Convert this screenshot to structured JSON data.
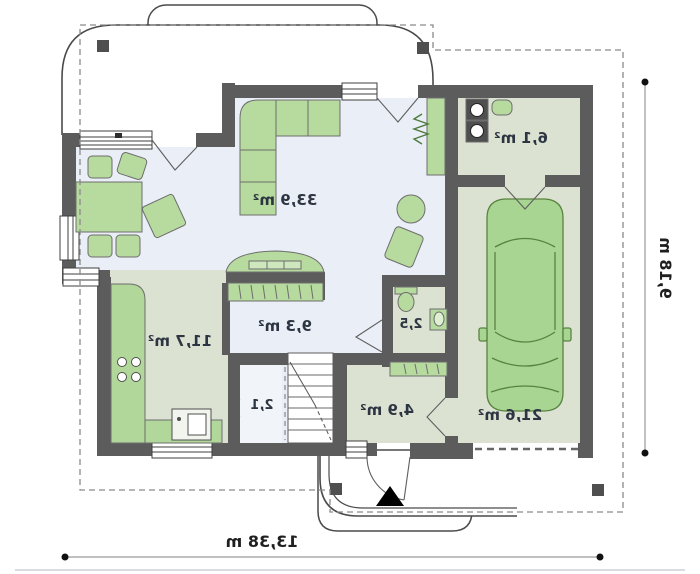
{
  "plan": {
    "type": "house-ground-floor-plan",
    "orientation": "mirrored"
  },
  "rooms": {
    "living": {
      "name": "living-room",
      "label": "33,9 m²"
    },
    "kitchen": {
      "name": "kitchen",
      "label": "11,7 m²"
    },
    "bedroom": {
      "name": "bedroom",
      "label": "9,3 m²"
    },
    "wc": {
      "name": "toilet-room",
      "label": "2,5"
    },
    "pantry": {
      "name": "pantry",
      "label": "2,1"
    },
    "hall": {
      "name": "entrance-hall",
      "label": "4,9 m²"
    },
    "utility": {
      "name": "utility-room",
      "label": "6,1 m²"
    },
    "garage": {
      "name": "garage",
      "label": "21,6 m²"
    }
  },
  "dimensions": {
    "width_label": "13,38 m",
    "height_label": "9,18 m"
  },
  "colors": {
    "wall": "#5c5c5c",
    "floor_light": "#eaeef6",
    "floor_green": "#dbe2d2",
    "furniture": "#b7db9f",
    "car": "#a8d692",
    "label_text": "#2e3542",
    "dimension_text": "#1f1f1f",
    "dash": "#8a8a8a",
    "outline": "#4a4a4a"
  },
  "furniture_icons": [
    "corner-sofa",
    "dining-table",
    "dining-chairs",
    "armchair",
    "side-table",
    "lounge-chair",
    "bed",
    "wardrobe",
    "kitchen-counter",
    "cooktop",
    "kitchen-sink",
    "toilet",
    "washbasin",
    "washer",
    "dryer",
    "cabinet",
    "radiator",
    "stairs",
    "car"
  ]
}
